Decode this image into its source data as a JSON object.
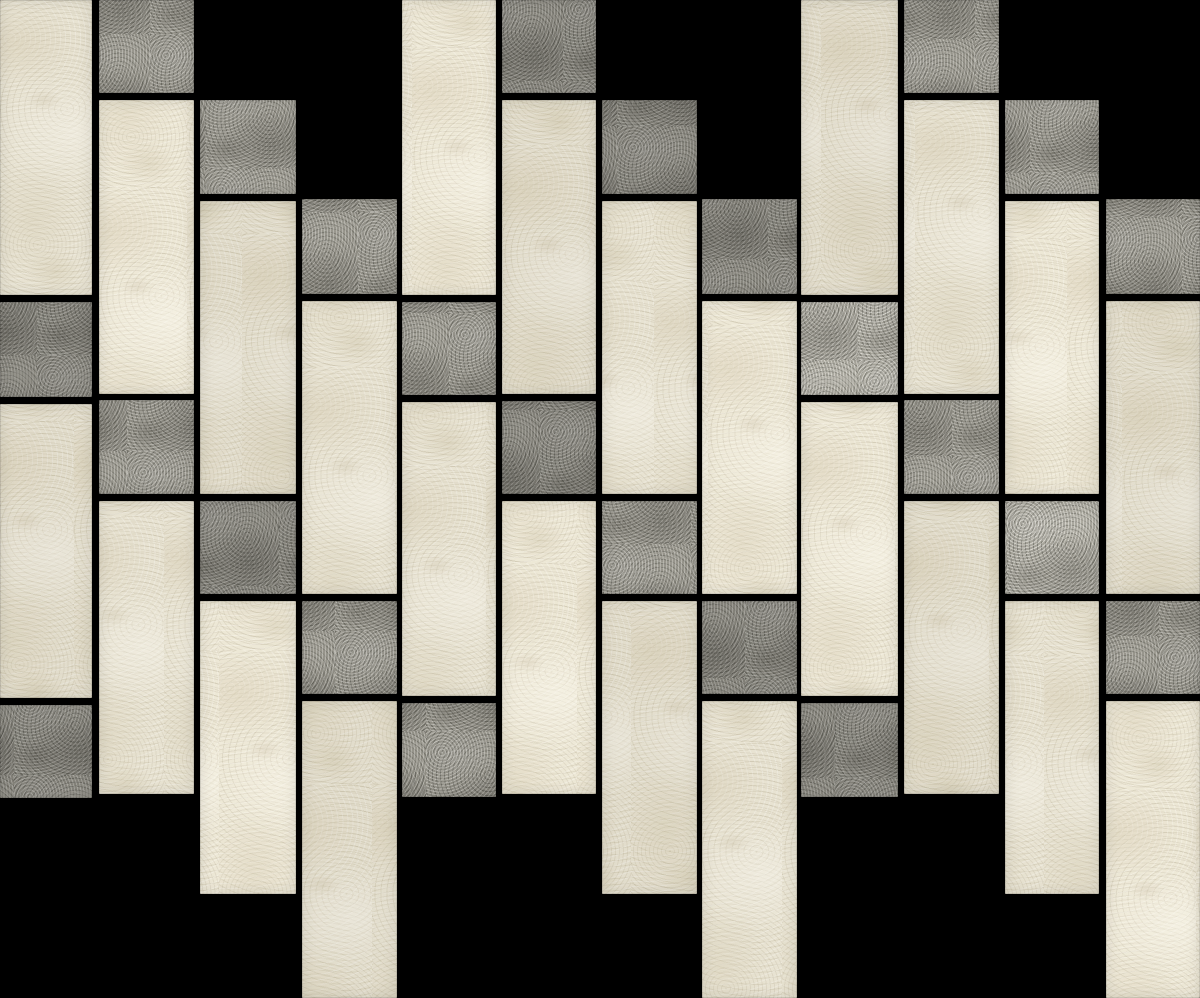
{
  "alt_text": "Stone-look mosaic tile sheet photographed on black grout: staggered columns of cream/beige vertical brick tiles with scattered gray square accent tiles, top and bottom edges stepped diagonally",
  "canvas": {
    "width_px": 1200,
    "height_px": 998,
    "grout_color": "#000000"
  },
  "palette": {
    "beige_base": "#e8e3d2",
    "beige_shadow": "#d5cdb5",
    "beige_highlight": "#f6f3e9",
    "gray_base": "#8e8c83",
    "gray_dark": "#7b7970",
    "gray_light": "#a9a79c",
    "grout": "#000000"
  },
  "grid": {
    "columns": 12,
    "column_pitch_px": 100.5,
    "tile_width_px": 95,
    "brick_height_px": 294,
    "square_height_px": 94,
    "grout_gap_px": 6,
    "column_phase_step_px": 100,
    "phase_repeat_every_columns": 4,
    "pattern": "staggered vertical brick mosaic with square accents, stepped sheet edges"
  },
  "tiles": [
    {
      "x": 0,
      "y": 0,
      "w": 92,
      "h": 295,
      "shape": "brick",
      "color": "beige",
      "variant": "b1"
    },
    {
      "x": 0,
      "y": 302,
      "w": 92,
      "h": 95,
      "shape": "square",
      "color": "gray",
      "variant": "g-dark"
    },
    {
      "x": 0,
      "y": 404,
      "w": 92,
      "h": 294,
      "shape": "brick",
      "color": "beige",
      "variant": "b2"
    },
    {
      "x": 0,
      "y": 705,
      "w": 92,
      "h": 93,
      "shape": "square",
      "color": "gray",
      "variant": "g-dark"
    },
    {
      "x": 99,
      "y": 0,
      "w": 95,
      "h": 93,
      "shape": "square",
      "color": "gray",
      "variant": "g-mid"
    },
    {
      "x": 99,
      "y": 100,
      "w": 95,
      "h": 294,
      "shape": "brick",
      "color": "beige",
      "variant": "b3"
    },
    {
      "x": 99,
      "y": 400,
      "w": 95,
      "h": 94,
      "shape": "square",
      "color": "gray",
      "variant": "g-mid"
    },
    {
      "x": 99,
      "y": 501,
      "w": 95,
      "h": 293,
      "shape": "brick",
      "color": "beige",
      "variant": "b1"
    },
    {
      "x": 200,
      "y": 100,
      "w": 96,
      "h": 94,
      "shape": "square",
      "color": "gray",
      "variant": "g-mid"
    },
    {
      "x": 200,
      "y": 201,
      "w": 96,
      "h": 293,
      "shape": "brick",
      "color": "beige",
      "variant": "b2"
    },
    {
      "x": 200,
      "y": 501,
      "w": 96,
      "h": 93,
      "shape": "square",
      "color": "gray",
      "variant": "g-dark"
    },
    {
      "x": 200,
      "y": 601,
      "w": 96,
      "h": 293,
      "shape": "brick",
      "color": "beige",
      "variant": "b3"
    },
    {
      "x": 302,
      "y": 199,
      "w": 95,
      "h": 95,
      "shape": "square",
      "color": "gray",
      "variant": "g-mid"
    },
    {
      "x": 302,
      "y": 301,
      "w": 95,
      "h": 293,
      "shape": "brick",
      "color": "beige",
      "variant": "b1"
    },
    {
      "x": 302,
      "y": 601,
      "w": 95,
      "h": 93,
      "shape": "square",
      "color": "gray",
      "variant": "g-mid"
    },
    {
      "x": 302,
      "y": 701,
      "w": 95,
      "h": 297,
      "shape": "brick",
      "color": "beige",
      "variant": "b2"
    },
    {
      "x": 402,
      "y": 0,
      "w": 94,
      "h": 295,
      "shape": "brick",
      "color": "beige",
      "variant": "b3"
    },
    {
      "x": 402,
      "y": 302,
      "w": 94,
      "h": 93,
      "shape": "square",
      "color": "gray",
      "variant": "g-mid"
    },
    {
      "x": 402,
      "y": 402,
      "w": 94,
      "h": 294,
      "shape": "brick",
      "color": "beige",
      "variant": "b1"
    },
    {
      "x": 402,
      "y": 703,
      "w": 94,
      "h": 94,
      "shape": "square",
      "color": "gray",
      "variant": "g-mid"
    },
    {
      "x": 502,
      "y": 0,
      "w": 94,
      "h": 93,
      "shape": "square",
      "color": "gray",
      "variant": "g-dark"
    },
    {
      "x": 502,
      "y": 100,
      "w": 94,
      "h": 294,
      "shape": "brick",
      "color": "beige",
      "variant": "b2"
    },
    {
      "x": 502,
      "y": 401,
      "w": 94,
      "h": 93,
      "shape": "square",
      "color": "gray",
      "variant": "g-dark"
    },
    {
      "x": 502,
      "y": 501,
      "w": 94,
      "h": 293,
      "shape": "brick",
      "color": "beige",
      "variant": "b3"
    },
    {
      "x": 602,
      "y": 100,
      "w": 95,
      "h": 94,
      "shape": "square",
      "color": "gray",
      "variant": "g-dark"
    },
    {
      "x": 602,
      "y": 201,
      "w": 95,
      "h": 293,
      "shape": "brick",
      "color": "beige",
      "variant": "b1"
    },
    {
      "x": 602,
      "y": 501,
      "w": 95,
      "h": 93,
      "shape": "square",
      "color": "gray",
      "variant": "g-mid"
    },
    {
      "x": 602,
      "y": 601,
      "w": 95,
      "h": 293,
      "shape": "brick",
      "color": "beige",
      "variant": "b2"
    },
    {
      "x": 702,
      "y": 199,
      "w": 95,
      "h": 95,
      "shape": "square",
      "color": "gray",
      "variant": "g-dark"
    },
    {
      "x": 702,
      "y": 301,
      "w": 95,
      "h": 293,
      "shape": "brick",
      "color": "beige",
      "variant": "b3"
    },
    {
      "x": 702,
      "y": 601,
      "w": 95,
      "h": 93,
      "shape": "square",
      "color": "gray",
      "variant": "g-dark"
    },
    {
      "x": 702,
      "y": 701,
      "w": 95,
      "h": 297,
      "shape": "brick",
      "color": "beige",
      "variant": "b1"
    },
    {
      "x": 801,
      "y": 0,
      "w": 97,
      "h": 295,
      "shape": "brick",
      "color": "beige",
      "variant": "b2"
    },
    {
      "x": 801,
      "y": 302,
      "w": 97,
      "h": 93,
      "shape": "square",
      "color": "gray",
      "variant": "g-light"
    },
    {
      "x": 801,
      "y": 402,
      "w": 97,
      "h": 294,
      "shape": "brick",
      "color": "beige",
      "variant": "b3"
    },
    {
      "x": 801,
      "y": 703,
      "w": 97,
      "h": 94,
      "shape": "square",
      "color": "gray",
      "variant": "g-dark"
    },
    {
      "x": 904,
      "y": 0,
      "w": 95,
      "h": 93,
      "shape": "square",
      "color": "gray",
      "variant": "g-mid"
    },
    {
      "x": 904,
      "y": 100,
      "w": 95,
      "h": 294,
      "shape": "brick",
      "color": "beige",
      "variant": "b1"
    },
    {
      "x": 904,
      "y": 400,
      "w": 95,
      "h": 94,
      "shape": "square",
      "color": "gray",
      "variant": "g-mid"
    },
    {
      "x": 904,
      "y": 501,
      "w": 95,
      "h": 293,
      "shape": "brick",
      "color": "beige",
      "variant": "b2"
    },
    {
      "x": 1005,
      "y": 100,
      "w": 94,
      "h": 94,
      "shape": "square",
      "color": "gray",
      "variant": "g-mid"
    },
    {
      "x": 1005,
      "y": 201,
      "w": 94,
      "h": 293,
      "shape": "brick",
      "color": "beige",
      "variant": "b3"
    },
    {
      "x": 1005,
      "y": 501,
      "w": 94,
      "h": 93,
      "shape": "square",
      "color": "gray",
      "variant": "g-light"
    },
    {
      "x": 1005,
      "y": 601,
      "w": 94,
      "h": 293,
      "shape": "brick",
      "color": "beige",
      "variant": "b1"
    },
    {
      "x": 1106,
      "y": 199,
      "w": 94,
      "h": 95,
      "shape": "square",
      "color": "gray",
      "variant": "g-mid"
    },
    {
      "x": 1106,
      "y": 301,
      "w": 94,
      "h": 293,
      "shape": "brick",
      "color": "beige",
      "variant": "b2"
    },
    {
      "x": 1106,
      "y": 601,
      "w": 94,
      "h": 93,
      "shape": "square",
      "color": "gray",
      "variant": "g-mid"
    },
    {
      "x": 1106,
      "y": 701,
      "w": 94,
      "h": 297,
      "shape": "brick",
      "color": "beige",
      "variant": "b3"
    }
  ]
}
